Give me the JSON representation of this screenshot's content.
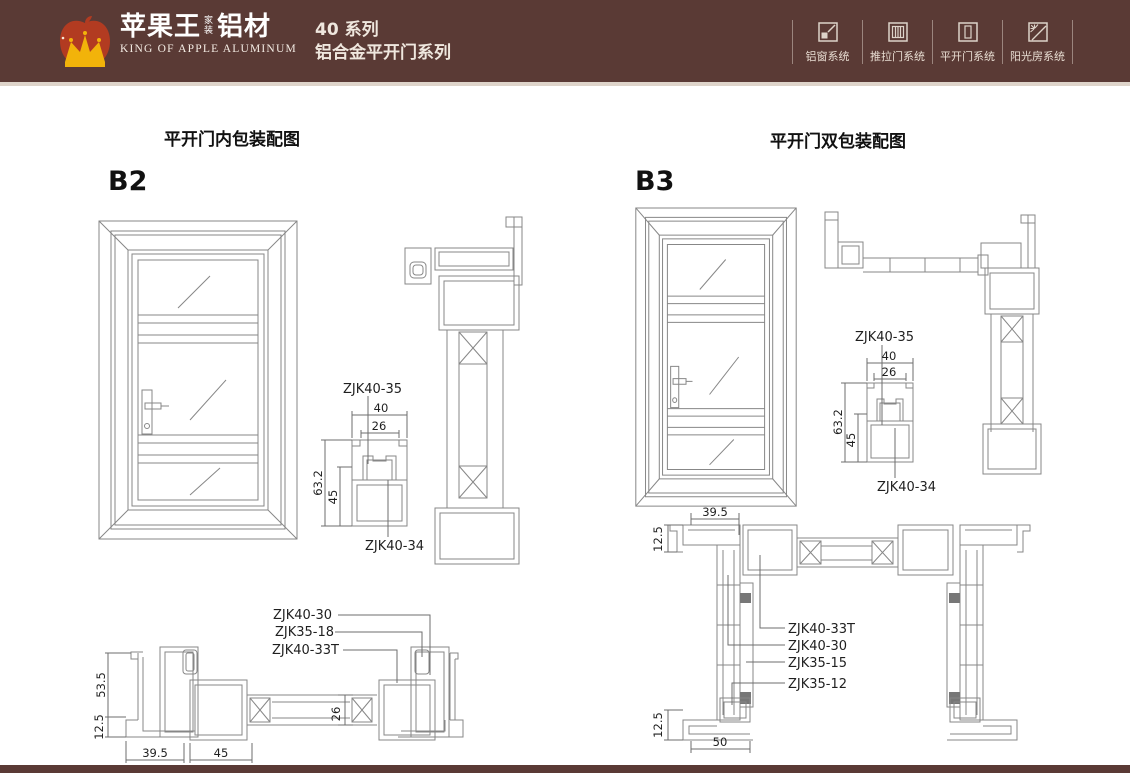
{
  "header": {
    "brand": {
      "cn_main": "苹果王",
      "cn_tag1": "家",
      "cn_tag2": "装",
      "cn_suffix": "铝材",
      "en": "KING OF APPLE ALUMINUM"
    },
    "series": {
      "line1": "40 系列",
      "line2": "铝合金平开门系列"
    },
    "nav": [
      {
        "label": "铝窗系统"
      },
      {
        "label": "推拉门系统"
      },
      {
        "label": "平开门系统"
      },
      {
        "label": "阳光房系统"
      }
    ]
  },
  "colors": {
    "header_bg": "#5a3a35",
    "footer_bg": "#5a3a35",
    "apple_red": "#b23b21",
    "crown_gold": "#f2b30a",
    "drawing_line": "#878787"
  },
  "left": {
    "title": "平开门内包装配图",
    "code": "B2",
    "cross": {
      "top_label": "ZJK40-35",
      "bottom_label": "ZJK40-34",
      "w": "40",
      "iw": "26",
      "h": "63.2",
      "lh": "45"
    },
    "bottom": {
      "p1": "ZJK40-30",
      "p2": "ZJK35-18",
      "p3": "ZJK40-33T",
      "h": "53.5",
      "s": "12.5",
      "w1": "39.5",
      "w2": "45",
      "g": "26"
    }
  },
  "right": {
    "title": "平开门双包装配图",
    "code": "B3",
    "cross": {
      "top_label": "ZJK40-35",
      "bottom_label": "ZJK40-34",
      "w": "40",
      "iw": "26",
      "h": "63.2",
      "lh": "45"
    },
    "bottom": {
      "p1": "ZJK40-33T",
      "p2": "ZJK40-30",
      "p3": "ZJK35-15",
      "p4": "ZJK35-12",
      "t": "39.5",
      "s1": "12.5",
      "s2": "12.5",
      "b": "50"
    }
  }
}
